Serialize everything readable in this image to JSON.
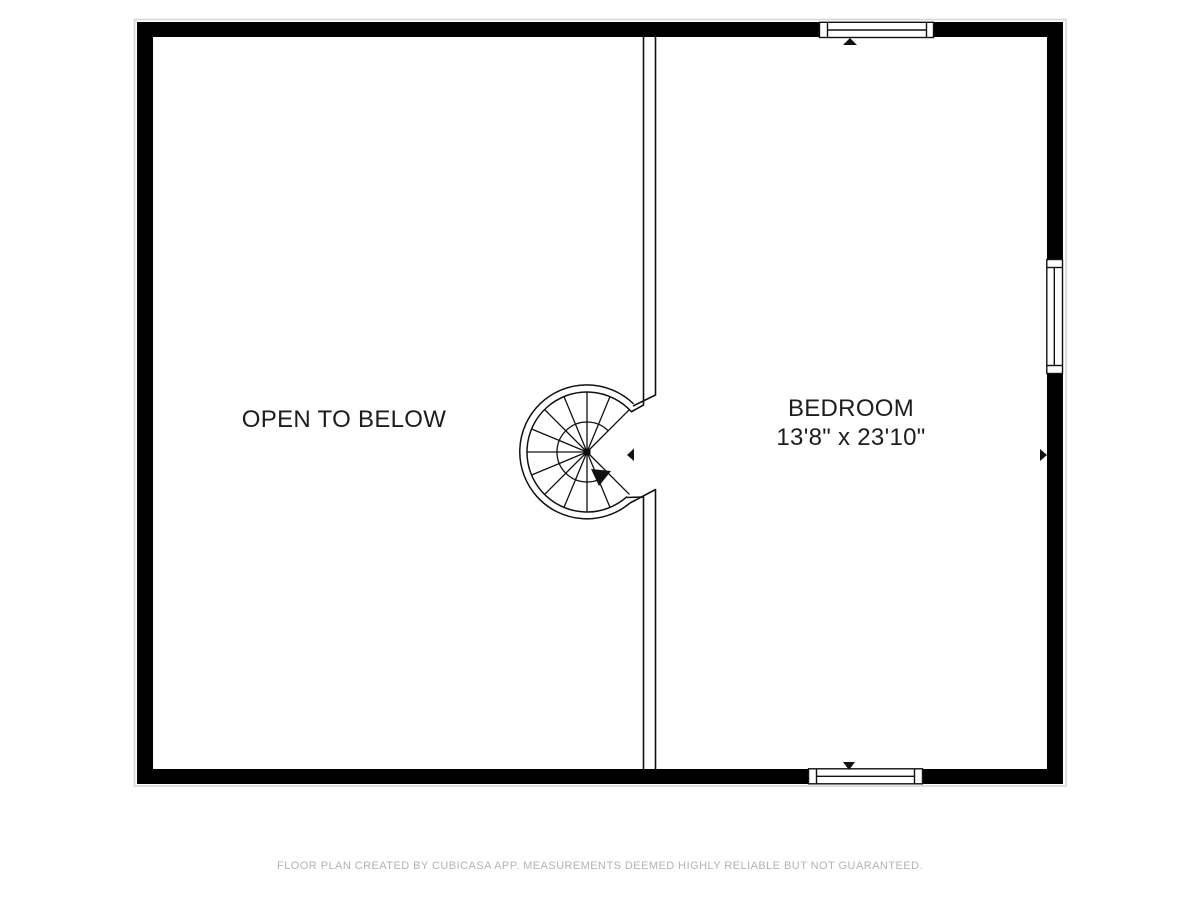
{
  "floor_plan": {
    "rooms": [
      {
        "name": "OPEN TO BELOW"
      },
      {
        "name": "BEDROOM",
        "dimensions": "13'8\" x 23'10\""
      }
    ],
    "markers": {
      "staircase": "spiral-staircase",
      "windows": 3,
      "direction_arrows": 5
    },
    "colors": {
      "wall": "#000000",
      "line": "#111111",
      "label_text": "#1d1d1f",
      "footer_text": "#b3b3b3",
      "background": "#ffffff",
      "shadow": "#d6d6d6"
    }
  },
  "footer": {
    "disclaimer": "FLOOR PLAN CREATED BY CUBICASA APP. MEASUREMENTS DEEMED HIGHLY RELIABLE BUT NOT GUARANTEED."
  }
}
